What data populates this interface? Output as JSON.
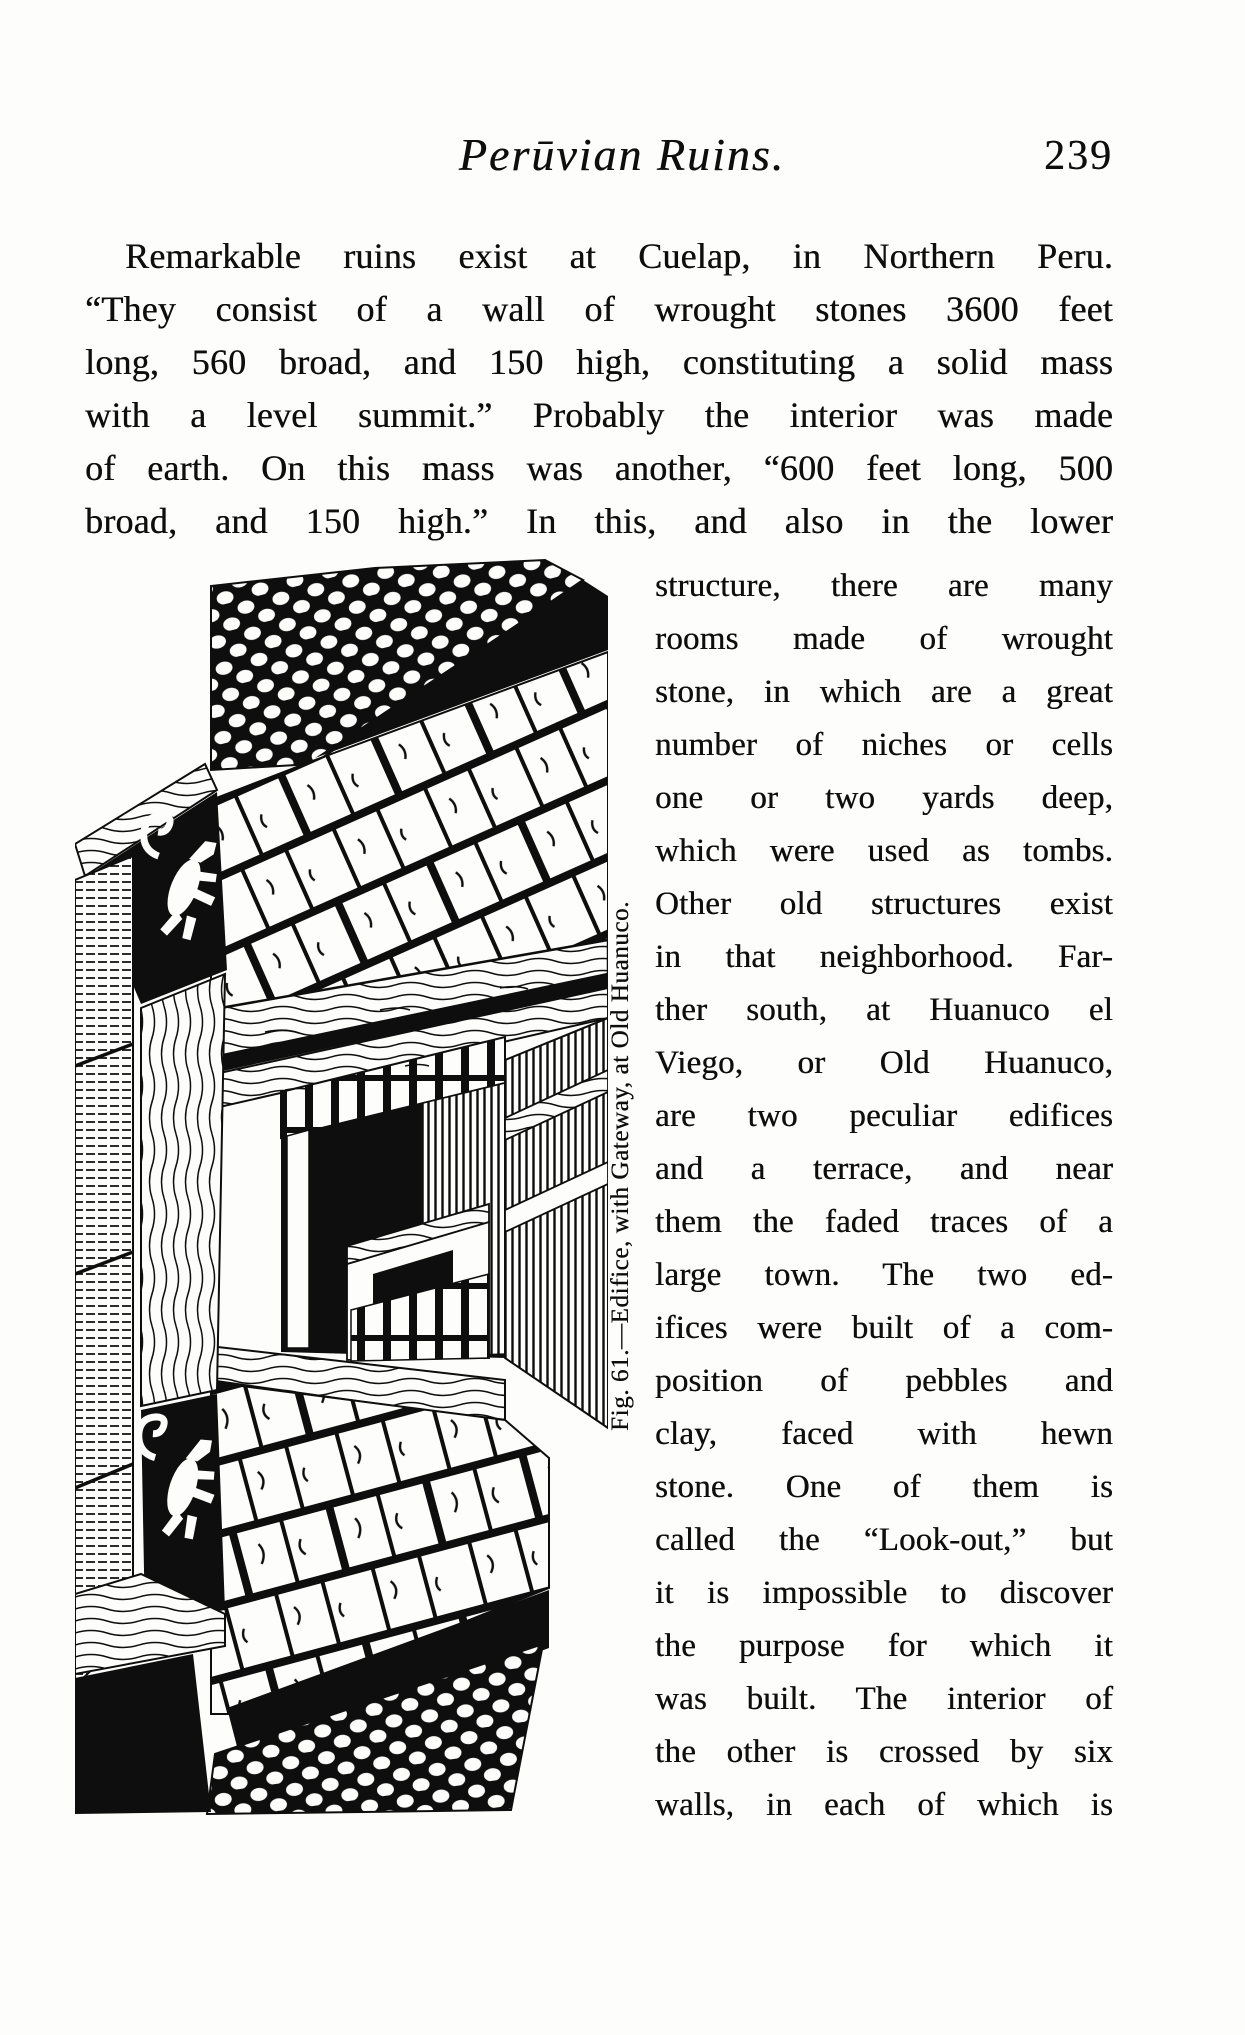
{
  "page": {
    "header": {
      "title": "Perūvian Ruins.",
      "page_number": "239"
    },
    "paragraph_lines": [
      "Remarkable ruins exist at Cuelap, in Northern Peru.",
      "“They consist of a wall of wrought stones 3600 feet",
      "long, 560 broad, and 150 high, constituting a solid mass",
      "with a level summit.”  Probably the interior was made",
      "of earth.  On this mass was another, “600 feet long, 500",
      "broad, and 150 high.”  In this, and also in the lower"
    ],
    "column_lines": [
      "structure, there are many",
      "rooms made of wrought",
      "stone, in which are a great",
      "number of niches or cells",
      "one or two yards deep,",
      "which were used as tombs.",
      "Other old structures exist",
      "in that neighborhood. Far-",
      "ther south, at Huanuco el",
      "Viego, or Old Huanuco,",
      "are two peculiar edifices",
      "and a terrace, and near",
      "them the faded traces of a",
      "large town.  The two ed-",
      "ifices were built of a com-",
      "position of pebbles and",
      "clay, faced with hewn",
      "stone.  One of them is",
      "called the “Look-out,” but",
      "it is impossible to discover",
      "the purpose for which it",
      "was built.  The interior of",
      "the other is crossed by six",
      "walls, in each of which is"
    ],
    "figure": {
      "caption": "Fig. 61.—Edifice, with Gateway, at Old Huanuco."
    },
    "colors": {
      "ink": "#0e0e0e",
      "paper": "#fdfdfb"
    }
  }
}
